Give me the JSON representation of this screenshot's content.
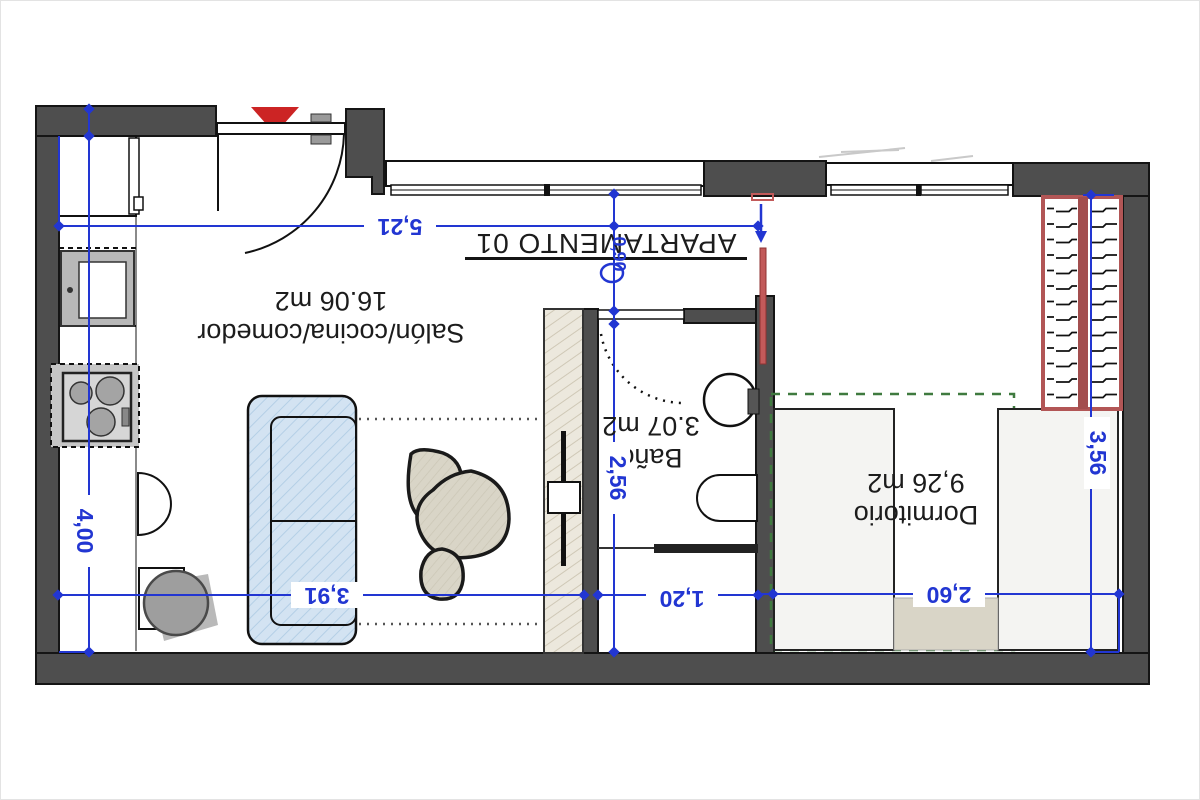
{
  "title": {
    "text": "APARTAMENTO 01"
  },
  "rooms": [
    {
      "name": "Salón/cocina/comedor",
      "area": "16.06 m2"
    },
    {
      "name": "Baño",
      "area": "3.07 m2"
    },
    {
      "name": "Dormitorio",
      "area": "9,26 m2"
    }
  ],
  "dimensions": [
    {
      "id": "salon-width",
      "value": "5,21"
    },
    {
      "id": "salon-depth",
      "value": "4,00"
    },
    {
      "id": "salon-inner-width",
      "value": "3,91"
    },
    {
      "id": "bath-depth",
      "value": "2,56"
    },
    {
      "id": "bath-width",
      "value": "1,20"
    },
    {
      "id": "bedroom-width",
      "value": "2,60"
    },
    {
      "id": "bedroom-depth",
      "value": "3,56"
    },
    {
      "id": "hall-width",
      "value": "0,90"
    }
  ],
  "palette": {
    "wall_gray": "#4e4e4e",
    "wall_outline": "#151515",
    "dimension_blue": "#2236d2",
    "entry_marker_red": "#cc2424",
    "wardrobe_red": "#b25656",
    "radiator_red": "#c25a5a",
    "closet_dash_green": "#3f7a3f",
    "couch_blue": "#d3e3f2",
    "furniture_beige": "#d9d5c7"
  }
}
